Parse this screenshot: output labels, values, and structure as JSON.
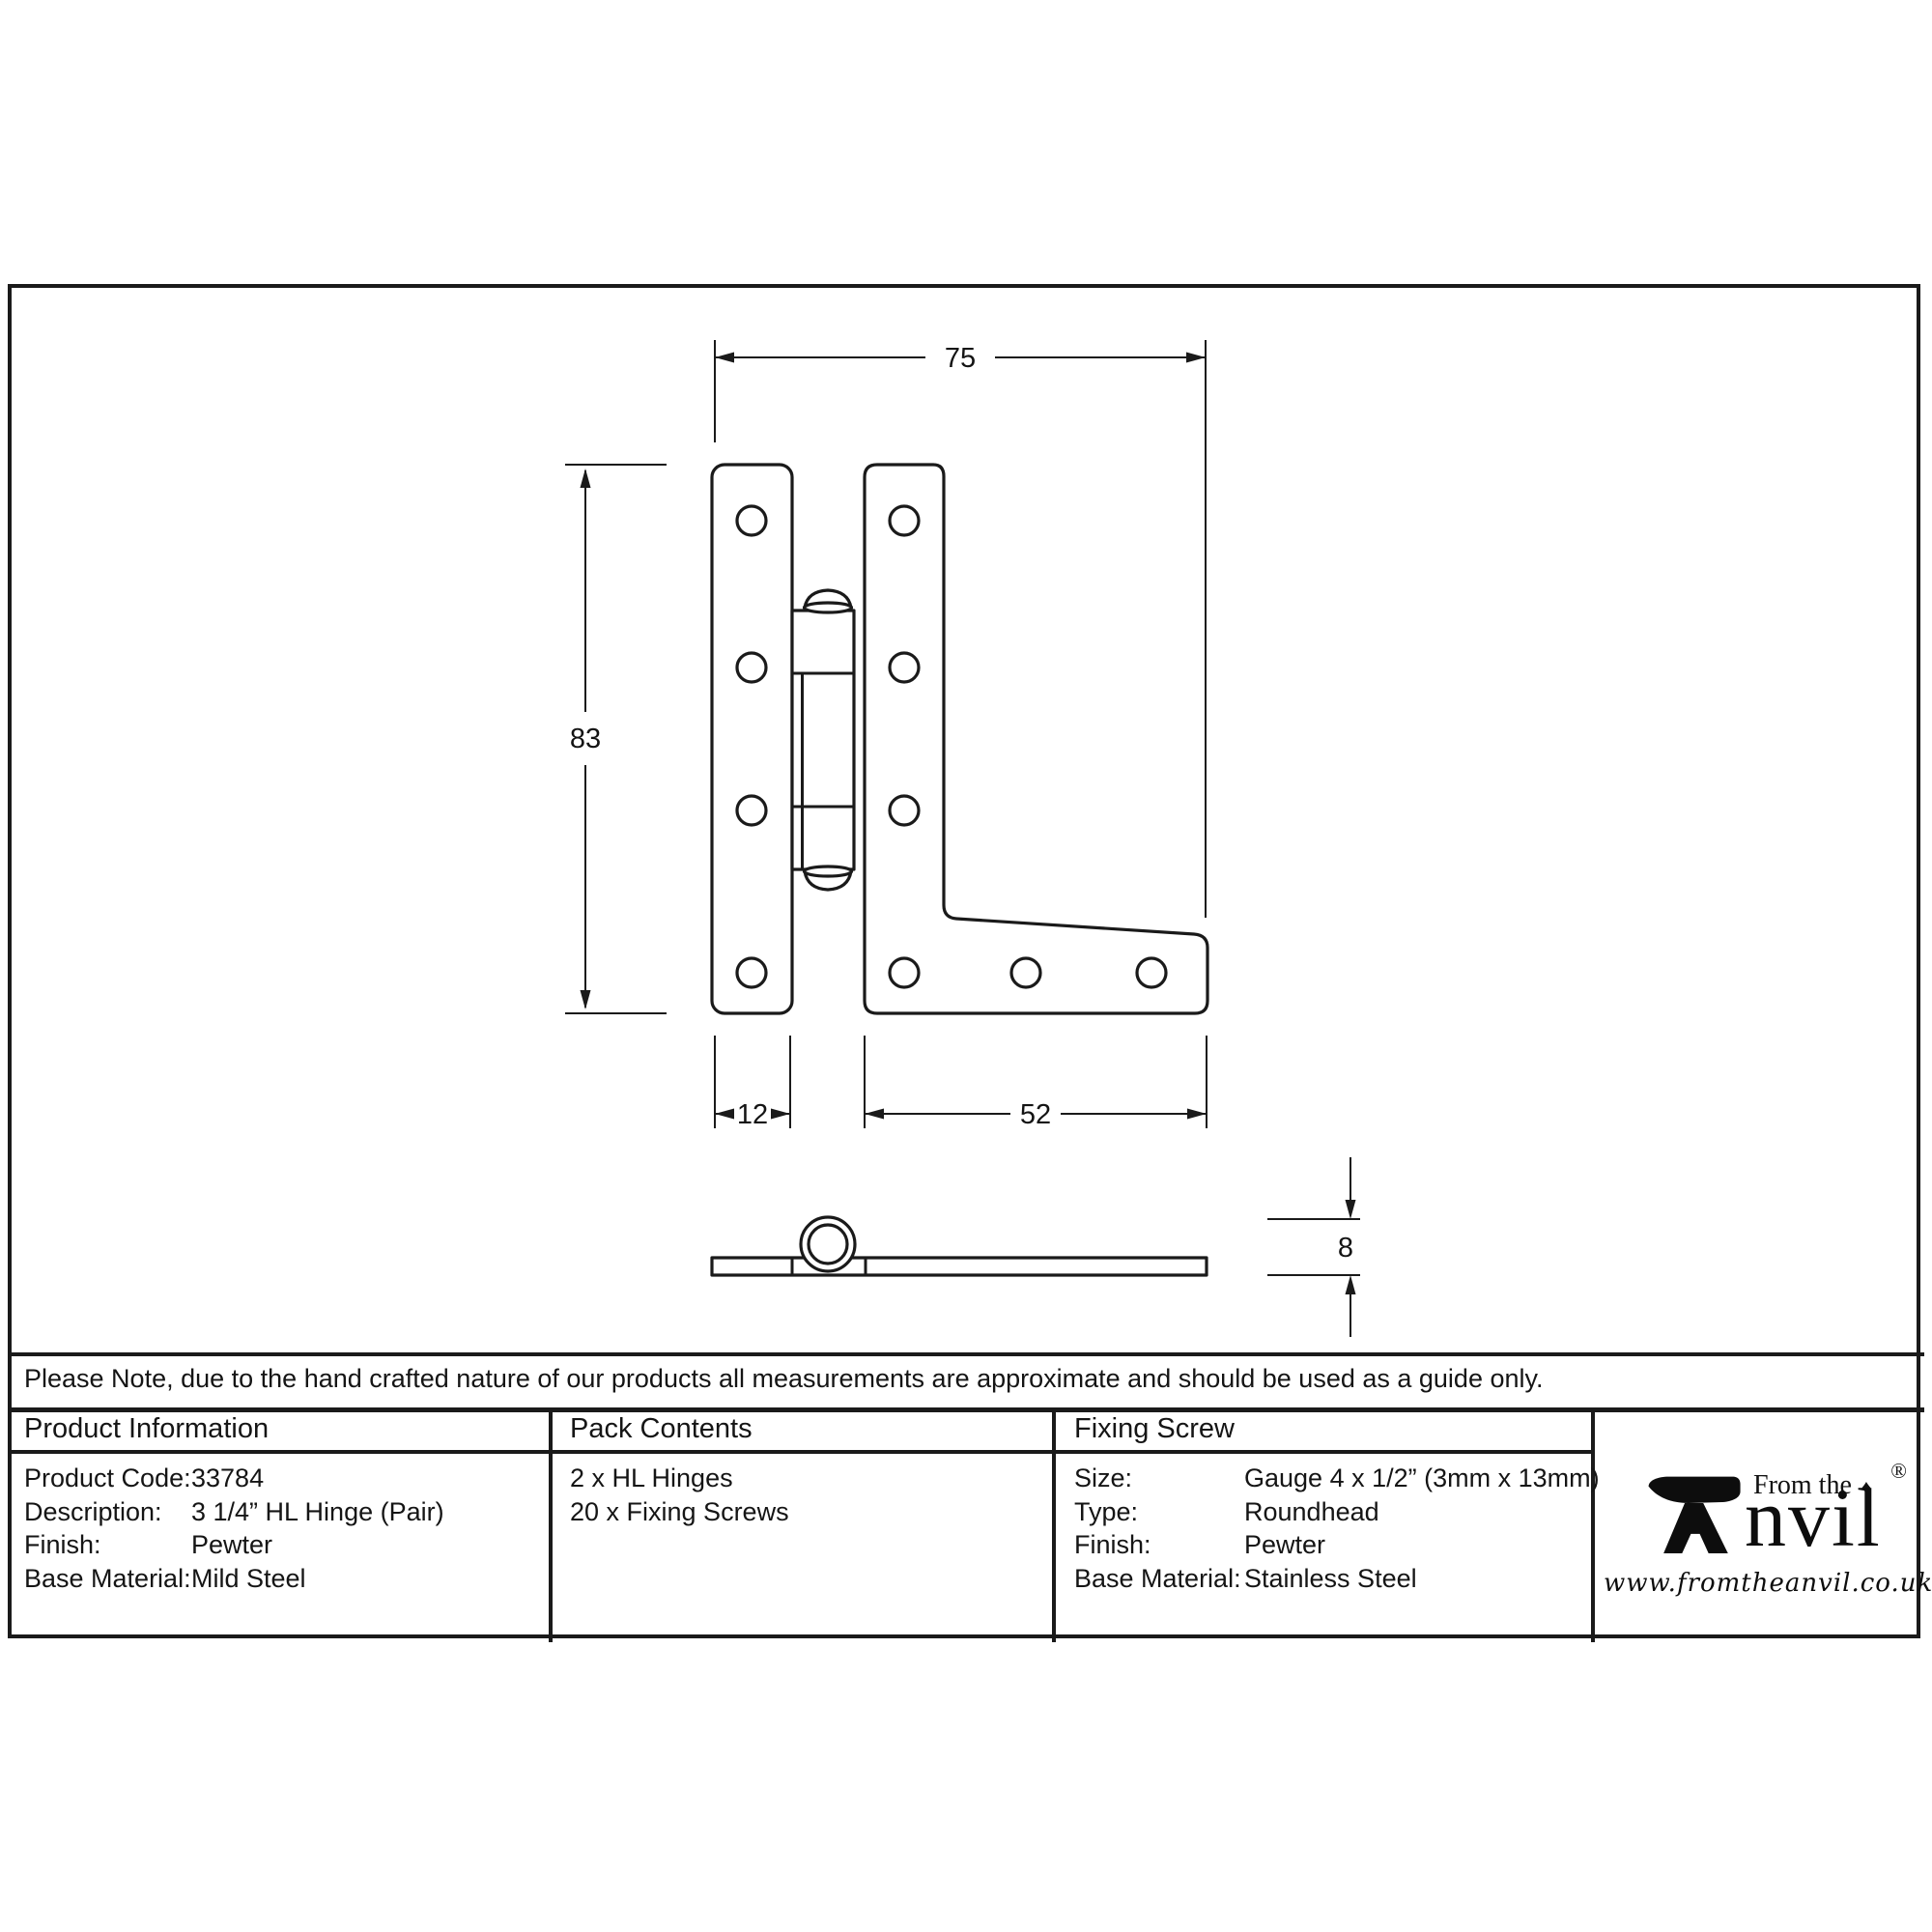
{
  "dimensions": {
    "overall_width": "75",
    "overall_height": "83",
    "leaf_width": "12",
    "arm_length": "52",
    "thickness": "8"
  },
  "note": "Please Note, due to the hand crafted nature of our products all measurements are approximate and should be used as a guide only.",
  "product_information": {
    "title": "Product Information",
    "rows": [
      {
        "label": "Product Code:",
        "value": "33784"
      },
      {
        "label": "Description:",
        "value": "3 1/4” HL Hinge (Pair)"
      },
      {
        "label": "Finish:",
        "value": "Pewter"
      },
      {
        "label": "Base Material:",
        "value": "Mild Steel"
      }
    ]
  },
  "pack_contents": {
    "title": "Pack Contents",
    "items": [
      "2 x HL Hinges",
      "20 x Fixing Screws"
    ]
  },
  "fixing_screw": {
    "title": "Fixing Screw",
    "rows": [
      {
        "label": "Size:",
        "value": "Gauge 4 x 1/2” (3mm x 13mm)"
      },
      {
        "label": "Type:",
        "value": "Roundhead"
      },
      {
        "label": "Finish:",
        "value": "Pewter"
      },
      {
        "label": "Base Material:",
        "value": "Stainless Steel"
      }
    ]
  },
  "brand": {
    "prefix": "From the",
    "name_rest": "nvil",
    "registered": "®",
    "diamond": "♦",
    "website": "www.fromtheanvil.co.uk"
  }
}
